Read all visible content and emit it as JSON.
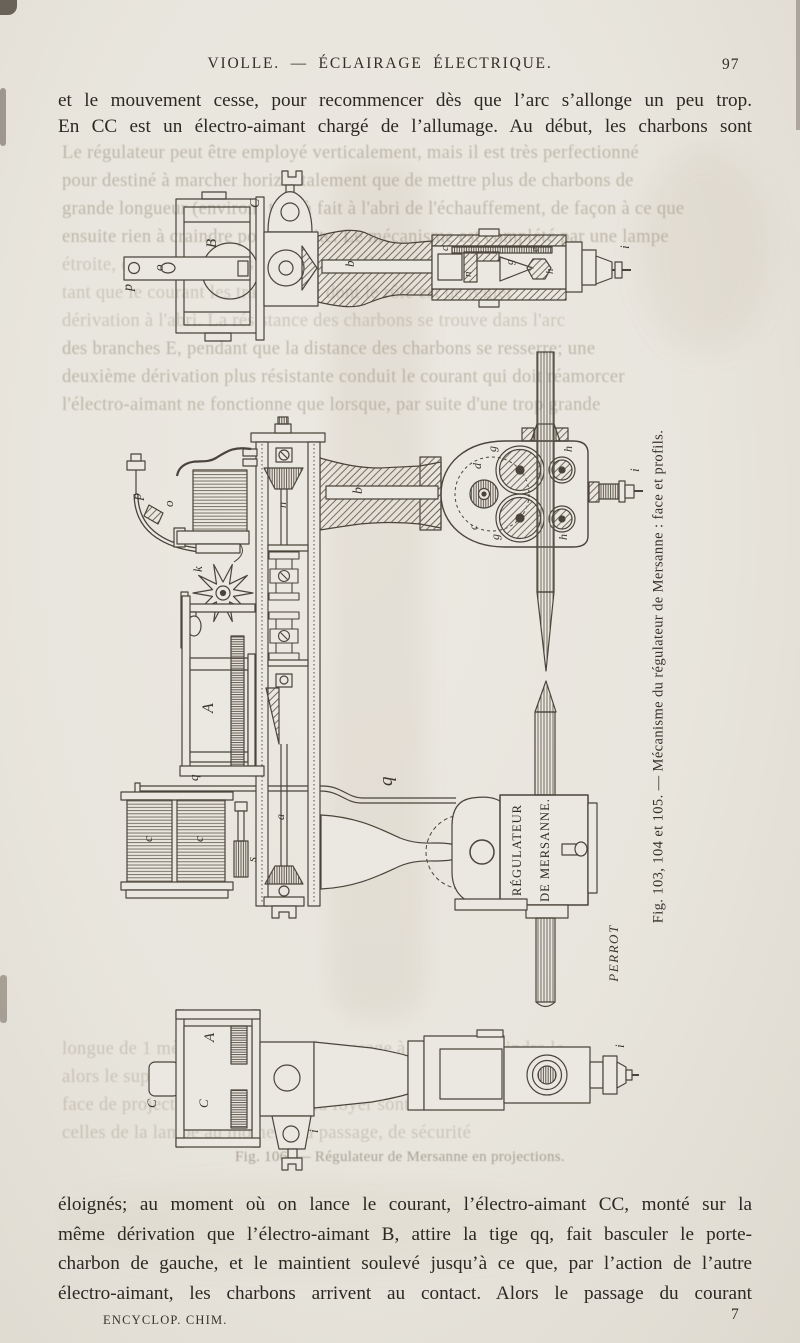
{
  "header": {
    "title": "VIOLLE. — ÉCLAIRAGE ÉLECTRIQUE.",
    "page_number": "97"
  },
  "paragraph_top": {
    "line1": "et le mouvement cesse, pour recommencer dès que l’arc s’allonge un peu trop.",
    "line2": "En CC est un électro-aimant chargé de l’allumage. Au début, les charbons sont"
  },
  "paragraph_bottom": {
    "line1": "éloignés; au moment où on lance le courant, l’électro-aimant CC, monté sur la",
    "line2": "même dérivation que l’électro-aimant B, attire la tige qq, fait basculer le porte-",
    "line3": "charbon de gauche, et le maintient soulevé jusqu’à ce que, par l’action de l’autre",
    "line4": "électro-aimant, les charbons arrivent au contact. Alors le passage du courant"
  },
  "footer": {
    "imprint": "ENCYCLOP. CHIM.",
    "sheet_number": "7"
  },
  "figures": {
    "caption": "Fig. 103, 104 et 105. — Mécanisme du régulateur de Mersanne : face et profils.",
    "plate": {
      "line1": "RÉGULATEUR",
      "line2": "DE MERSANNE."
    },
    "engraver": "PERROT",
    "part_labels": {
      "A": "A",
      "B": "B",
      "C": "C",
      "a": "a",
      "b": "b",
      "c": "c",
      "d": "d",
      "e": "e",
      "g": "g",
      "h": "h",
      "i": "i",
      "k": "k",
      "n": "n",
      "o": "o",
      "p": "p",
      "q": "q",
      "s": "s"
    }
  },
  "bleedthrough": {
    "lines": [
      "Le régulateur peut être employé verticalement, mais il est très perfectionné",
      "pour destiné à marcher horizontalement que de mettre plus de charbons de",
      "grande longueur (environ) tout à fait à l'abri de l'échauffement, de façon à ce que",
      "ensuite rien à craindre pour la suite. Le mécanisme est complété par une lampe",
      "étroite, qui retiennent les pièces entre elles et les maintiennent",
      "tant que le courant les traverse, et dont le rôle est de régler",
      "dérivation à l'abri. La résistance des charbons se trouve dans l'arc",
      "des branches E, pendant que la distance des charbons se resserre; une",
      "deuxième dérivation plus résistante conduit le courant qui doit réamorcer",
      "l'électro-aimant ne fonctionne que lorsque, par suite d'une trop grande",
      "longue de 1 mètre, comprise sur le passage à (1) pour atteindre le",
      "alors le supplément de lumière se produit au moment quand le",
      "face de projection qui se trouve au foyer sont montées à",
      "celles de la lampe au moment du passage, de sécurité",
      "Fig. 106. — Régulateur de Mersanne en projections."
    ]
  }
}
